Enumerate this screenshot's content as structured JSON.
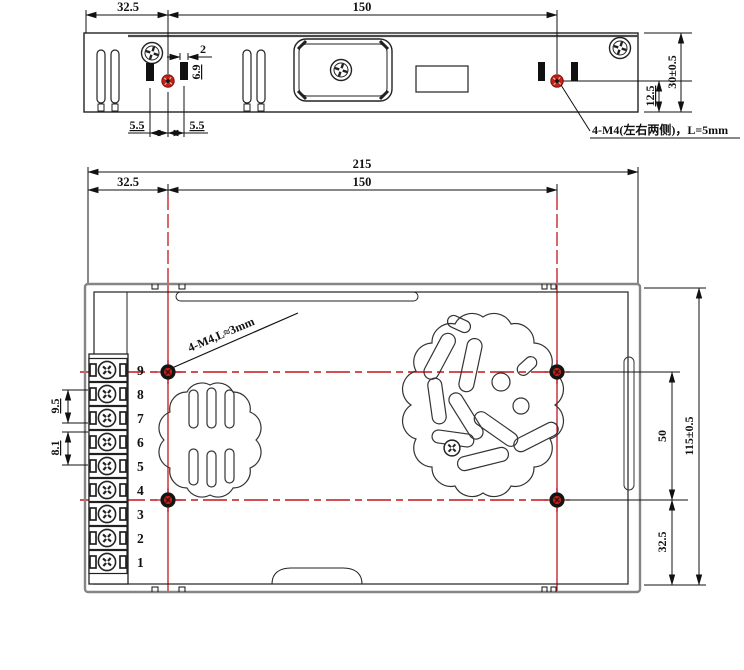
{
  "top_view": {
    "dim_width_left": "32.5",
    "dim_width_main": "150",
    "dim_slot_width": "2",
    "dim_slot_height": "6.9",
    "dim_offset_left": "5.5",
    "dim_offset_right": "5.5",
    "dim_height": "30±0.5",
    "dim_hole_height": "12.5",
    "note": "4-M4(左右两侧)，L=5mm"
  },
  "bottom_view": {
    "dim_total_width": "215",
    "dim_hole_left": "32.5",
    "dim_hole_span": "150",
    "dim_pitch_a": "9.5",
    "dim_pitch_b": "8.1",
    "dim_hole_vspan": "50",
    "dim_total_height": "115±0.5",
    "dim_hole_bottom": "32.5",
    "note": "4-M4,L≈3mm",
    "terminals": [
      "9",
      "8",
      "7",
      "6",
      "5",
      "4",
      "3",
      "2",
      "1"
    ]
  },
  "colors": {
    "line": "#1c1c1c",
    "centerline_red": "#c3161c",
    "hole_red": "#c42015"
  }
}
